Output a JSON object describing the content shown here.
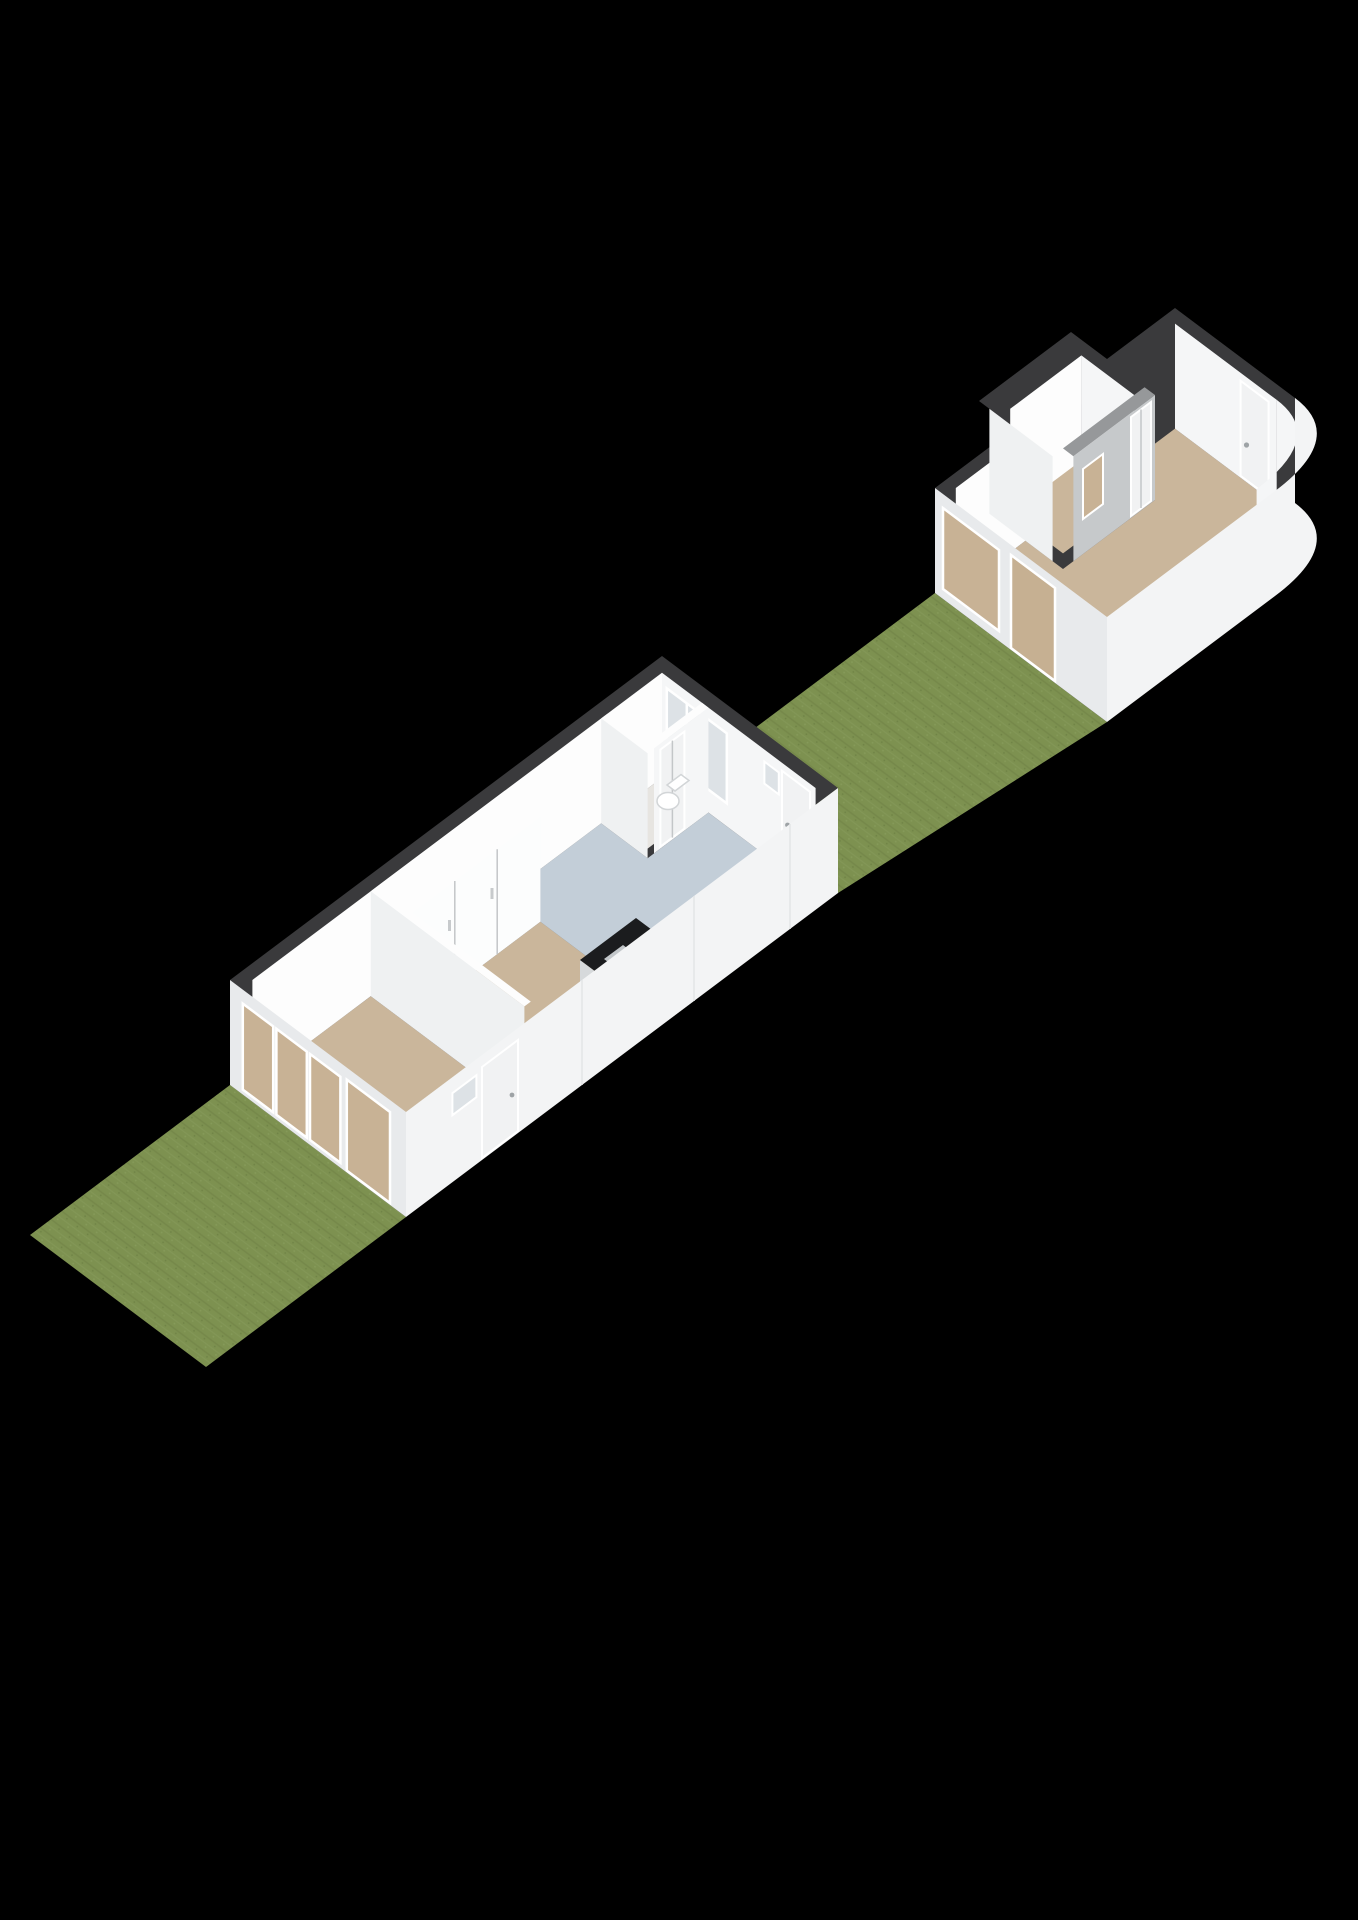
{
  "scene": {
    "description": "3D isometric floor-plan render on black background: a single-storey main house (bottom left) and a detached garden shed with curved corner wall (top right) connected by a grass strip",
    "projection": "isometric-3d",
    "background": "#000000"
  },
  "colors": {
    "background": "#000000",
    "wall_top": "#3a3a3c",
    "wall_inner_white": "#fdfdfd",
    "wall_inner_light": "#f5f6f7",
    "wall_face_int": "#eff1f2",
    "facade_shaded": "#e8eaec",
    "facade_light": "#f3f4f5",
    "floor_tan": "#cab69b",
    "floor_blue": "#c3ced8",
    "floor_light": "#e7e5e1",
    "lawn": "#7d9150",
    "lawn_dark": "#6e8145",
    "pane_tan": "#c8b295",
    "pane_blue": "#dde2e6",
    "frame_white": "#ffffff",
    "door_white": "#f1f2f3",
    "door_tan": "#c6b092",
    "shed_gray_top": "#96989a",
    "shed_gray_face": "#c6c9cb",
    "island_top": "#1b1c1e",
    "island_face": "#d6d9db",
    "island_face_light": "#fcfdfd",
    "sink_outer": "#c3c7ca",
    "sink_inner": "#979da1",
    "fixture": "#ffffff"
  },
  "main_house": {
    "name": "main-house",
    "rooms": [
      {
        "name": "living-room",
        "floor": "blue-gray"
      },
      {
        "name": "kitchen-hall",
        "floor": "tan"
      },
      {
        "name": "bedroom",
        "floor": "tan"
      },
      {
        "name": "toilet-room",
        "floor": "light-gray"
      }
    ],
    "fixtures": [
      "kitchen-island-with-sink",
      "wall-hung-toilet",
      "built-in-closets"
    ],
    "openings": [
      "bedroom-facade-windows",
      "facade-glass-door",
      "garden-door-with-transom",
      "living-room-window",
      "toilet-door",
      "rear-door-with-transom"
    ]
  },
  "shed": {
    "name": "garden-shed",
    "rooms": [
      {
        "name": "shed-storage-room",
        "floor": "tan"
      },
      {
        "name": "shed-main-room",
        "floor": "tan"
      }
    ],
    "features": [
      "curved-corner-wall",
      "interior-window",
      "interior-door",
      "side-door-with-handle",
      "facade-window",
      "facade-tan-door"
    ]
  },
  "landscape": {
    "front_lawn": "grass",
    "back_lawn": "grass"
  }
}
